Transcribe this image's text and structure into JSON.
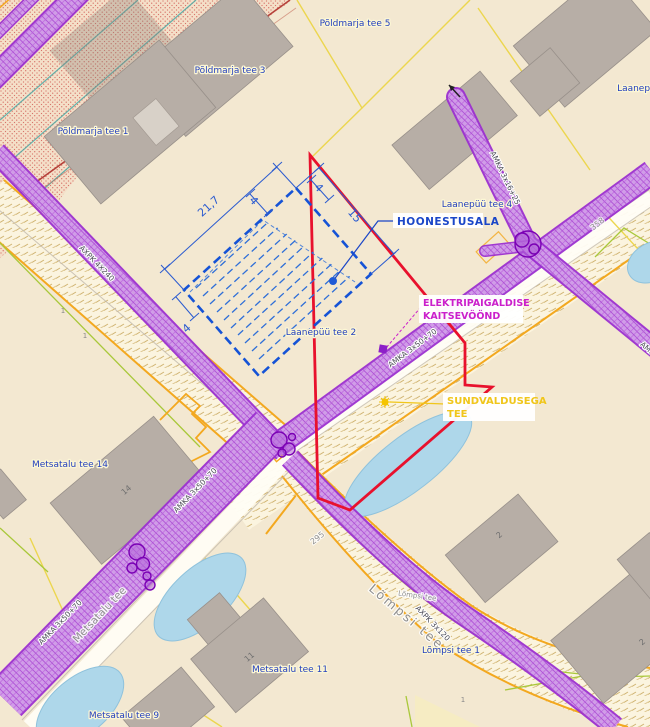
{
  "map": {
    "colors": {
      "boundary_red": "#e8112d",
      "hoonestus_blue": "#1553d6",
      "band_purple": "#9b2fd0",
      "callout_blue": "#1a46c8",
      "callout_magenta": "#cb1fcb",
      "callout_yellow": "#f0c61a",
      "road_orange": "#f3a81f",
      "pond_blue": "#aed7ea",
      "parcel_yellow": "#ecd64e",
      "parcel_green": "#a9c83a"
    },
    "callouts": {
      "hoonestusala": "HOONESTUSALA",
      "elektri_line1": "ELEKTRIPAIGALDISE",
      "elektri_line2": "KAITSEVÖÖND",
      "sund_line1": "SUNDVALDUSEGA",
      "sund_line2": "TEE"
    },
    "dimensions": {
      "d217": "21,7",
      "d15": "15",
      "d4a": "4",
      "d4b": "4",
      "d4c": "4"
    },
    "addresses": [
      "Põldmarja tee 5",
      "Põldmarja tee 3",
      "Põldmarja tee 1",
      "Laanepüü tee",
      "Laanepüü tee 4",
      "Laanepüü tee 2",
      "Metsatalu tee 14",
      "Metsatalu tee 11",
      "Metsatalu tee 9",
      "Lõmpsi tee 1"
    ],
    "streets": [
      "Metsatalu tee",
      "Lõmpsi tee",
      "Lõmpsi tee"
    ],
    "road_numbers": [
      "358",
      "295"
    ],
    "cables": [
      "AMKA 3x16+25",
      "AMKA 3x50+70",
      "AMKA 3x50+70",
      "AMKA 3x50+70",
      "AXPK 4X240",
      "AXPK 3x120",
      "AMKA"
    ],
    "building_numbers": [
      "14",
      "2",
      "2",
      "11"
    ],
    "parcel_marks": [
      "1",
      "1",
      "1"
    ]
  }
}
